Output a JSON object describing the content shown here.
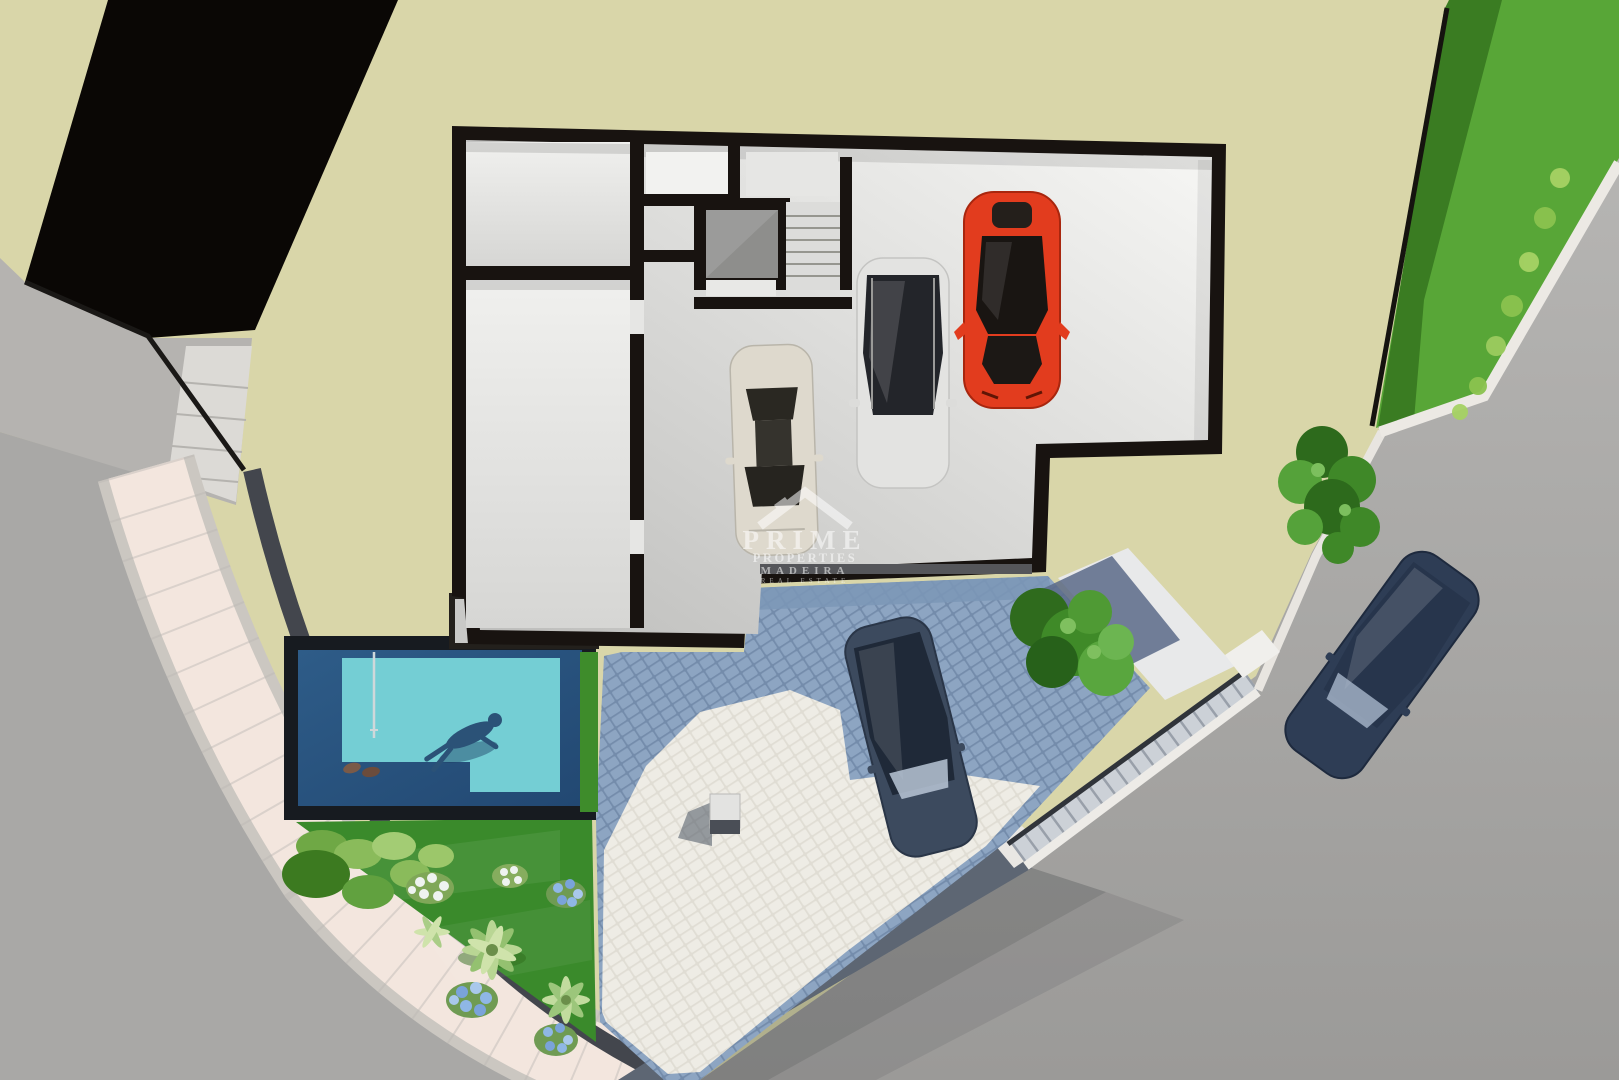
{
  "scene": {
    "description": "Aerial 3D architectural render of a villa plot: basement level floor plan with storage rooms, elevator, staircase and 3-car garage, outdoor pool with swimmer, landscaped garden, cobblestone driveway with parked car, external stairs and surrounding road",
    "level_label": "Basement / garage level"
  },
  "watermark": {
    "line1": "PRIME",
    "line2": "PROPERTIES",
    "line3": "MADEIRA",
    "line4": "REAL ESTATE"
  },
  "colors": {
    "land": "#d9d6a9",
    "neighbor_roof": "#0a0705",
    "pavement": "#b5b3b0",
    "road": "#a9a8a6",
    "sidewalk": "#f3e6de",
    "curb": "#cbc7c1",
    "wall_band": "#43464d",
    "building_wall": "#181310",
    "garage_floor_light": "#f7f7f5",
    "garage_floor_dark": "#c0c0be",
    "elevator_shaft": "#8e8e8c",
    "stair_tread": "#dcdcda",
    "pool_frame": "#171b20",
    "pool_water_deep": "#2b5682",
    "pool_water_light": "#74ced4",
    "swimmer": "#2b5277",
    "hedge": "#3e8c2b",
    "garden_grass": "#3a8a2b",
    "palm_light": "#b9d694",
    "hydrangea_blue": "#7aa3da",
    "flower_white": "#eef3f0",
    "driveway_blue": "#7e97b6",
    "driveway_light": "#e7e4dc",
    "grass_verge": "#58a637",
    "verge_shadow": "#3a7c22",
    "curb_white": "#ece9e4",
    "car_red": "#e23c1e",
    "car_white": "#ded9cd",
    "car_silver": "#e3e3e1",
    "car_dark_gray": "#3c4a5e",
    "car_dark_blue": "#2e3d55"
  },
  "vehicles": [
    {
      "name": "white-sedan",
      "location": "garage",
      "color": "#ded9cd"
    },
    {
      "name": "silver-estate",
      "location": "garage",
      "color": "#e3e3e1"
    },
    {
      "name": "red-sports-car",
      "location": "garage",
      "color": "#e23c1e"
    },
    {
      "name": "dark-gray-sedan",
      "location": "driveway",
      "color": "#3c4a5e"
    },
    {
      "name": "dark-blue-sedan",
      "location": "road",
      "color": "#2e3d55"
    }
  ],
  "features": [
    "storage room",
    "technical room",
    "elevator shaft",
    "interior staircase",
    "3-car garage",
    "swimming pool with swimmer and ladder",
    "garden with palms and hydrangeas",
    "cobblestone driveway",
    "external staircase to road",
    "grass verge",
    "curved sidewalk"
  ]
}
